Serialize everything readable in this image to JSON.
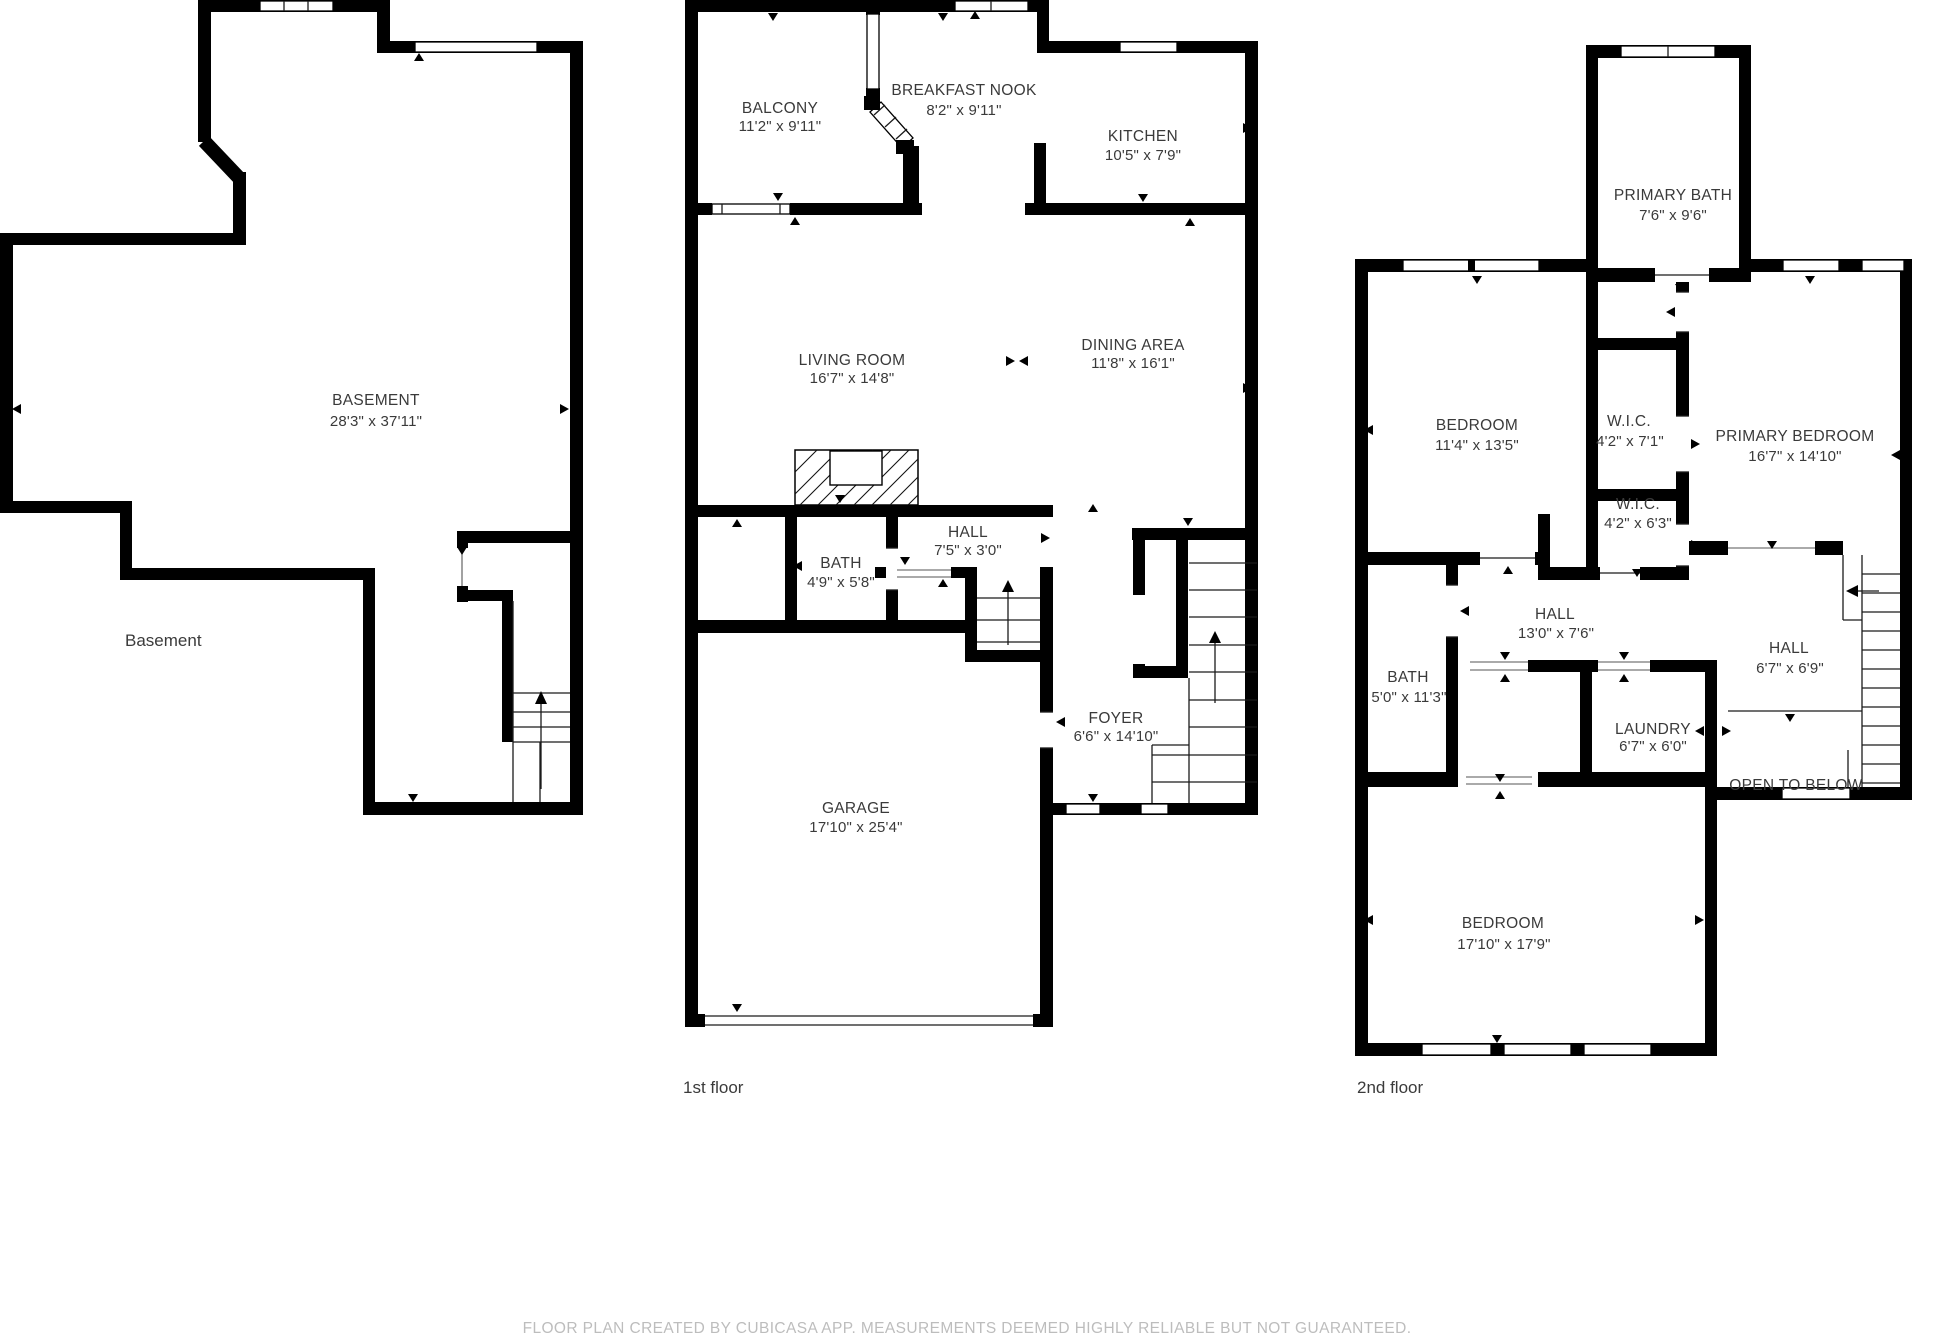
{
  "meta": {
    "background_color": "#ffffff",
    "wall_color": "#000000",
    "label_color": "#3a3a3a",
    "footer_color": "#bdbdbd"
  },
  "floors": [
    {
      "caption": "Basement",
      "rooms": [
        {
          "name": "BASEMENT",
          "dims": "28'3\" x 37'11\""
        }
      ]
    },
    {
      "caption": "1st floor",
      "rooms": [
        {
          "name": "BALCONY",
          "dims": "11'2\" x 9'11\""
        },
        {
          "name": "BREAKFAST NOOK",
          "dims": "8'2\" x 9'11\""
        },
        {
          "name": "KITCHEN",
          "dims": "10'5\" x 7'9\""
        },
        {
          "name": "LIVING ROOM",
          "dims": "16'7\" x 14'8\""
        },
        {
          "name": "DINING AREA",
          "dims": "11'8\" x 16'1\""
        },
        {
          "name": "BATH",
          "dims": "4'9\" x 5'8\""
        },
        {
          "name": "HALL",
          "dims": "7'5\" x 3'0\""
        },
        {
          "name": "FOYER",
          "dims": "6'6\" x 14'10\""
        },
        {
          "name": "GARAGE",
          "dims": "17'10\" x 25'4\""
        }
      ]
    },
    {
      "caption": "2nd floor",
      "rooms": [
        {
          "name": "PRIMARY BATH",
          "dims": "7'6\" x 9'6\""
        },
        {
          "name": "BEDROOM",
          "dims": "11'4\" x 13'5\""
        },
        {
          "name": "W.I.C.",
          "dims": "4'2\" x 7'1\""
        },
        {
          "name": "PRIMARY BEDROOM",
          "dims": "16'7\" x 14'10\""
        },
        {
          "name": "W.I.C.",
          "dims": "4'2\" x 6'3\""
        },
        {
          "name": "HALL",
          "dims": "13'0\" x 7'6\""
        },
        {
          "name": "BATH",
          "dims": "5'0\" x 11'3\""
        },
        {
          "name": "HALL",
          "dims": "6'7\" x 6'9\""
        },
        {
          "name": "LAUNDRY",
          "dims": "6'7\" x 6'0\""
        },
        {
          "name": "OPEN TO BELOW",
          "dims": ""
        },
        {
          "name": "BEDROOM",
          "dims": "17'10\" x 17'9\""
        }
      ]
    }
  ],
  "footer": "FLOOR PLAN CREATED BY CUBICASA APP. MEASUREMENTS DEEMED HIGHLY RELIABLE BUT NOT GUARANTEED."
}
